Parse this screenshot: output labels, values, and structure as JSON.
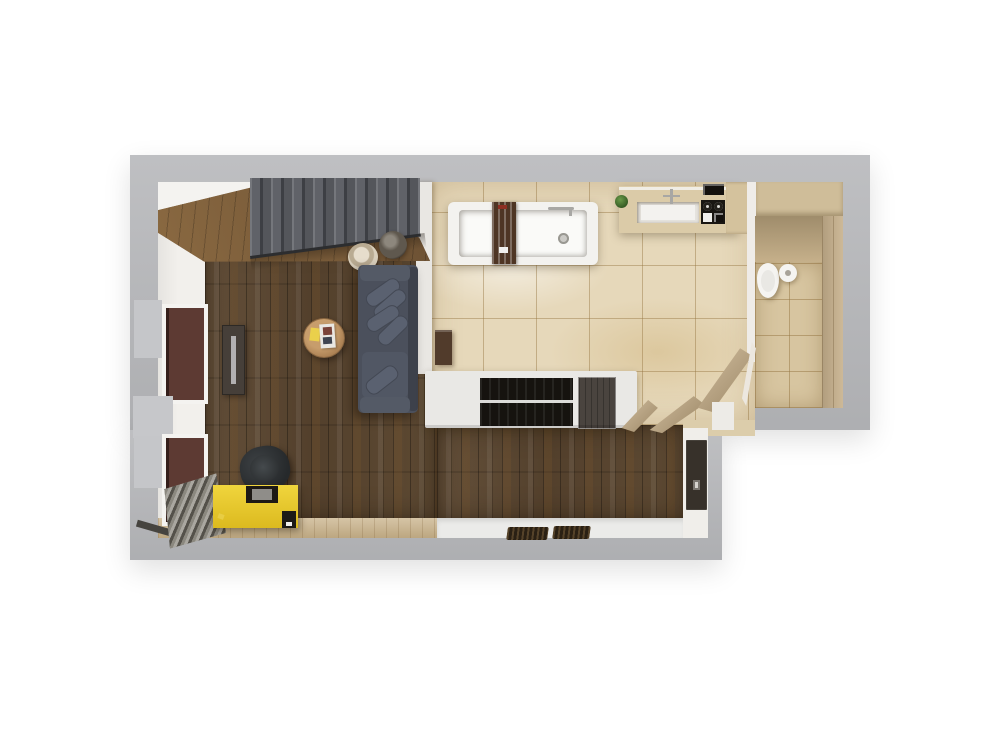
{
  "scene": {
    "type": "3d-apartment-floor-plan-top-view",
    "background": "#ffffff",
    "rooms": [
      {
        "name": "living-room",
        "floor": "dark-walnut-parquet"
      },
      {
        "name": "kitchen",
        "floor": "beige-marble-tile"
      },
      {
        "name": "bathroom",
        "floor": "beige-tile"
      },
      {
        "name": "hallway",
        "floor": "dark-walnut-parquet"
      },
      {
        "name": "entry",
        "floor": "white-stone"
      }
    ],
    "objects": [
      "staircase",
      "floor-pouf",
      "round-vase",
      "sofa-with-pillows",
      "coffee-table",
      "sticky-note",
      "magazine",
      "tv-console",
      "desk",
      "office-chair",
      "monitor",
      "radiator",
      "window-x2",
      "bathtub",
      "bath-caddy",
      "kitchen-counter",
      "sink",
      "stove",
      "plant",
      "island-shelf-counter",
      "open-doors-x3",
      "entrance-door",
      "doormat-x2",
      "toilet",
      "side-cabinet"
    ]
  },
  "palette": {
    "wall_band": "#b7b8bb",
    "lining": "#f2f0ec",
    "wedge_white": "#f4f3f0",
    "parquet": "#5a462f",
    "landing": "#7b5c39",
    "tile": "#e6d8ba",
    "lightwood": "#c8b188",
    "entry_floor": "#ebebe9",
    "half_wall": "#e9e7e3",
    "stairs": "#5a5c60",
    "rail": "#2c2d2f",
    "pouf": "#d8cdbb",
    "vase": "#5f584e",
    "sill": "#c5c6c9",
    "cap_gray": "#c6c7ca",
    "window_reveal": "#5d3a33",
    "console": "#463f39",
    "console_slot": "#b2b0b1",
    "table_wood": "#b68d5c",
    "note_yellow": "#ead04b",
    "magazine_white": "#e9e7e2",
    "magazine_art": "#7a4238",
    "sofa_body": "#4b505c",
    "sofa_back": "#3d414b",
    "sofa_arm": "#545a66",
    "pillow": "#5a6170",
    "seat": "#515764",
    "desk_yellow": "#e6c42d",
    "monitor_dark": "#1d1915",
    "monitor_screen": "#8f8d89",
    "sidebox_dark": "#1c1a17",
    "chair_dark": "#2a2d2f",
    "chair_seat": "#3c4043",
    "radiator": "#8a877f",
    "threshold_dark": "#46443f",
    "sideboard_brown": "#513b2b",
    "tub_white": "#f3f2ef",
    "tub_inner": "#fafaf8",
    "caddy_brown": "#4e3524",
    "caddy_label_red": "#8d2f23",
    "soap_white": "#f0efec",
    "faucet_chrome": "#a8a7a4",
    "drain_gray": "#cbcac6",
    "counter_wood": "#dbcba8",
    "counter_rail": "#f0ede5",
    "sink_rim": "#e5e3de",
    "sink_inner": "#f3f2ef",
    "plant_green": "#4e7a33",
    "stove_black": "#191612",
    "burner_ring": "#dad8d4",
    "oven_black": "#14110e",
    "tall_unit": "#d4c29d",
    "upper_cab": "#cfbd99",
    "gray_block": "#a8a399",
    "bath_strip": "#efece8",
    "bath_wall_top": "#c2ab83",
    "bath_floor": "#d7c5a0",
    "bath_wall_right": "#c9b38f",
    "toilet_white": "#f5f4f1",
    "toilet_inner": "#e9e8e4",
    "island_slab": "#e9e8e5",
    "shelf_black": "#16130f",
    "shelf_line": "#dddcd9",
    "cabinet_dark": "#4a443f",
    "vestibule_tile": "#dccdab",
    "door_tan": "#c2a77c",
    "door_frame_white": "#ece7df",
    "corner_white": "#edebe7",
    "wall_face": "#f0eeea",
    "entry_door": "#37312a",
    "door_handle": "#d6d4cf",
    "mat_dark": "#2a2014"
  }
}
